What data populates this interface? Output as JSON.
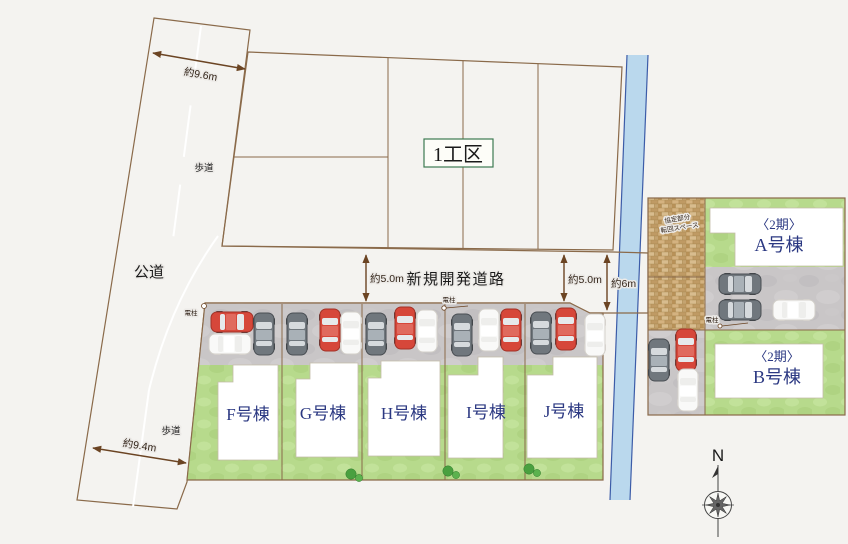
{
  "labels": {
    "district": "1工区",
    "new_road": "新規開発道路",
    "public_road": "公道",
    "sidewalk_top": "歩道",
    "sidewalk_bottom": "歩道",
    "dim_width_top": "約9.6m",
    "dim_width_bottom": "約9.4m",
    "dim_road_left": "約5.0m",
    "dim_road_right": "約5.0m",
    "dim_road_end": "約6m",
    "pole_road": "電柱",
    "pole_left": "電柱",
    "pole_right": "電柱",
    "agreement_line1": "協定部分",
    "agreement_line2": "転回スペース",
    "compass_north": "N"
  },
  "phase2": {
    "tag_a": "〈2期〉",
    "name_a": "A号棟",
    "tag_b": "〈2期〉",
    "name_b": "B号棟"
  },
  "lots": [
    {
      "id": "F",
      "label": "F号棟"
    },
    {
      "id": "G",
      "label": "G号棟"
    },
    {
      "id": "H",
      "label": "H号棟"
    },
    {
      "id": "I",
      "label": "I号棟"
    },
    {
      "id": "J",
      "label": "J号棟"
    }
  ],
  "cars": [
    {
      "x": 232,
      "y": 322,
      "rot": 90,
      "color": "red"
    },
    {
      "x": 230,
      "y": 344,
      "rot": 90,
      "color": "white"
    },
    {
      "x": 264,
      "y": 334,
      "rot": 0,
      "color": "gray"
    },
    {
      "x": 297,
      "y": 334,
      "rot": 0,
      "color": "gray"
    },
    {
      "x": 330,
      "y": 330,
      "rot": 0,
      "color": "red"
    },
    {
      "x": 351,
      "y": 333,
      "rot": 0,
      "color": "white"
    },
    {
      "x": 376,
      "y": 334,
      "rot": 0,
      "color": "gray"
    },
    {
      "x": 405,
      "y": 328,
      "rot": 0,
      "color": "red"
    },
    {
      "x": 427,
      "y": 331,
      "rot": 0,
      "color": "white"
    },
    {
      "x": 462,
      "y": 335,
      "rot": 0,
      "color": "gray"
    },
    {
      "x": 489,
      "y": 330,
      "rot": 0,
      "color": "white"
    },
    {
      "x": 511,
      "y": 330,
      "rot": 0,
      "color": "red"
    },
    {
      "x": 541,
      "y": 333,
      "rot": 0,
      "color": "gray"
    },
    {
      "x": 566,
      "y": 329,
      "rot": 0,
      "color": "red"
    },
    {
      "x": 595,
      "y": 335,
      "rot": 0,
      "color": "white"
    },
    {
      "x": 740,
      "y": 284,
      "rot": 90,
      "color": "gray"
    },
    {
      "x": 740,
      "y": 310,
      "rot": 90,
      "color": "gray"
    },
    {
      "x": 794,
      "y": 310,
      "rot": 90,
      "color": "white"
    },
    {
      "x": 659,
      "y": 360,
      "rot": 0,
      "color": "gray"
    },
    {
      "x": 686,
      "y": 350,
      "rot": 0,
      "color": "red"
    },
    {
      "x": 688,
      "y": 390,
      "rot": 0,
      "color": "white"
    }
  ],
  "trees": [
    {
      "x": 351,
      "y": 474,
      "r": 5.2
    },
    {
      "x": 359,
      "y": 478,
      "r": 3.6
    },
    {
      "x": 448,
      "y": 471,
      "r": 5.2
    },
    {
      "x": 456,
      "y": 475,
      "r": 3.6
    },
    {
      "x": 529,
      "y": 469,
      "r": 5.2
    },
    {
      "x": 537,
      "y": 473,
      "r": 3.6
    }
  ],
  "colors": {
    "background": "#f4f3f0",
    "road": "#c9c6c7",
    "district_fill": "#f6eec8",
    "grass": "#b7da8c",
    "water": "#bad8ed",
    "water_edge": "#3c5ca8",
    "border_brown": "#8a6a4a",
    "dim_brown": "#6b4423",
    "navy_text": "#2b3882",
    "green_text": "#1e6b3a",
    "car_red": "#d6473a",
    "car_gray": "#70777d",
    "car_white": "#f9f9f8"
  }
}
